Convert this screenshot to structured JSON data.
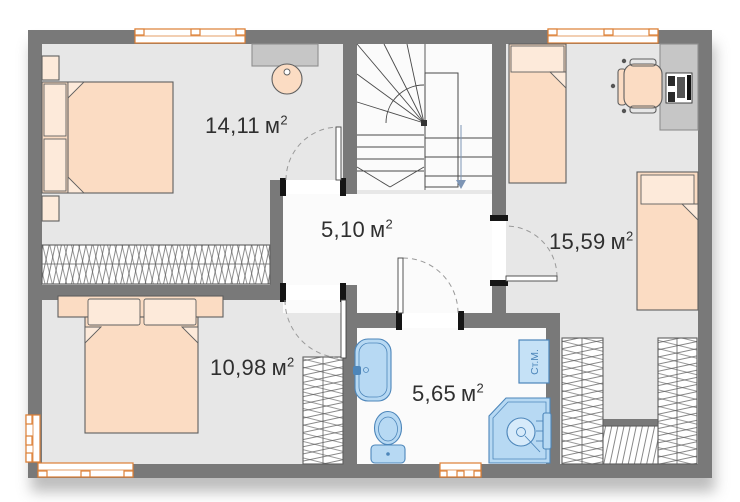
{
  "plan": {
    "rooms": [
      {
        "id": "bedroom-1",
        "area_value": "14,11",
        "area_unit": "м",
        "area_sup": "2"
      },
      {
        "id": "hall",
        "area_value": "5,10",
        "area_unit": "м",
        "area_sup": "2"
      },
      {
        "id": "bedroom-2",
        "area_value": "15,59",
        "area_unit": "м",
        "area_sup": "2"
      },
      {
        "id": "bedroom-3",
        "area_value": "10,98",
        "area_unit": "м",
        "area_sup": "2"
      },
      {
        "id": "bathroom",
        "area_value": "5,65",
        "area_unit": "м",
        "area_sup": "2"
      }
    ],
    "appliances": {
      "washing_machine_label": "Ст.М."
    },
    "colors": {
      "wall": "#797979",
      "room-floor": "#e7e7e7",
      "light-floor": "#fbfbfb",
      "peach": "#fbdcc3",
      "peach-light": "#fdeada",
      "outline": "#5f5f5f",
      "window-frame": "#dd7f35",
      "fixture-blue": "#b7d9f3",
      "fixture-blue-dark": "#4d86ba",
      "desk-gray": "#c6c6c6",
      "hatch": "#555555",
      "label-text": "#2f2f2f"
    }
  }
}
